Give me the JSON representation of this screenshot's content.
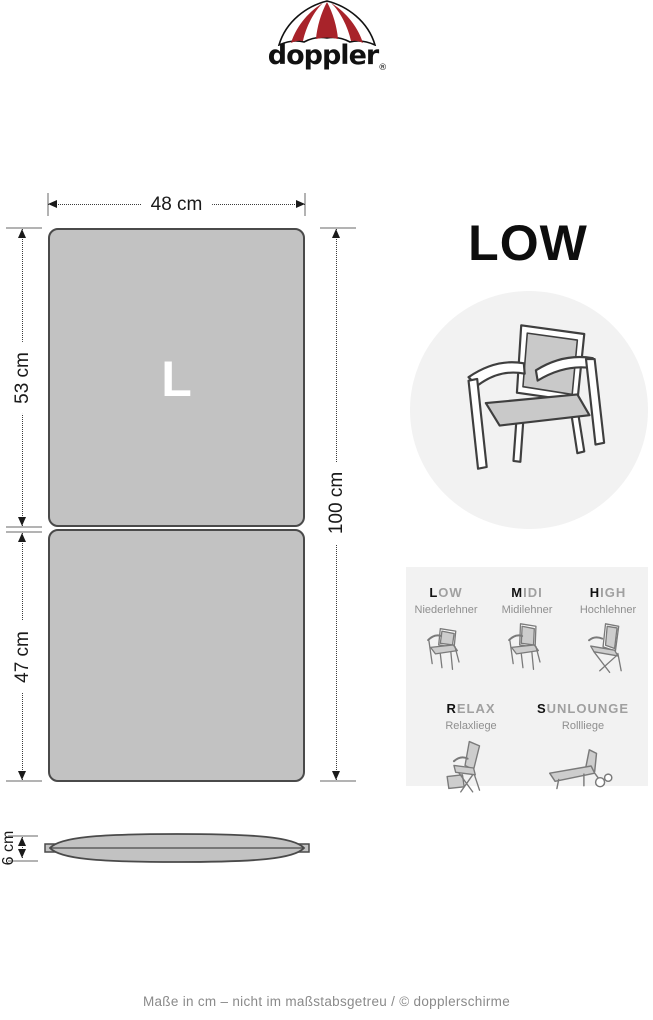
{
  "brand": {
    "name": "doppler",
    "registered": "®"
  },
  "cushion": {
    "size_letter": "L",
    "width_label": "48 cm",
    "back_section_label": "53 cm",
    "seat_section_label": "47 cm",
    "total_length_label": "100 cm",
    "thickness_label": "6 cm"
  },
  "type_heading": "LOW",
  "type_panel": {
    "row1": [
      {
        "name_first": "L",
        "name_rest": "OW",
        "subtitle": "Niederlehner"
      },
      {
        "name_first": "M",
        "name_rest": "IDI",
        "subtitle": "Midilehner"
      },
      {
        "name_first": "H",
        "name_rest": "IGH",
        "subtitle": "Hochlehner"
      }
    ],
    "row2": [
      {
        "name_first": "R",
        "name_rest": "ELAX",
        "subtitle": "Relaxliege"
      },
      {
        "name_first": "S",
        "name_rest": "UNLOUNGE",
        "subtitle": "Rollliege"
      }
    ]
  },
  "footer": {
    "text": "Maße in cm – nicht im maßstabsgetreu / © dopplerschirme"
  },
  "colors": {
    "brand_red": "#a8232a",
    "cushion_fill": "#c2c2c2",
    "cushion_border": "#4a4a4a",
    "panel_bg": "#f2f2f2",
    "muted_text": "#8f8f8f"
  }
}
